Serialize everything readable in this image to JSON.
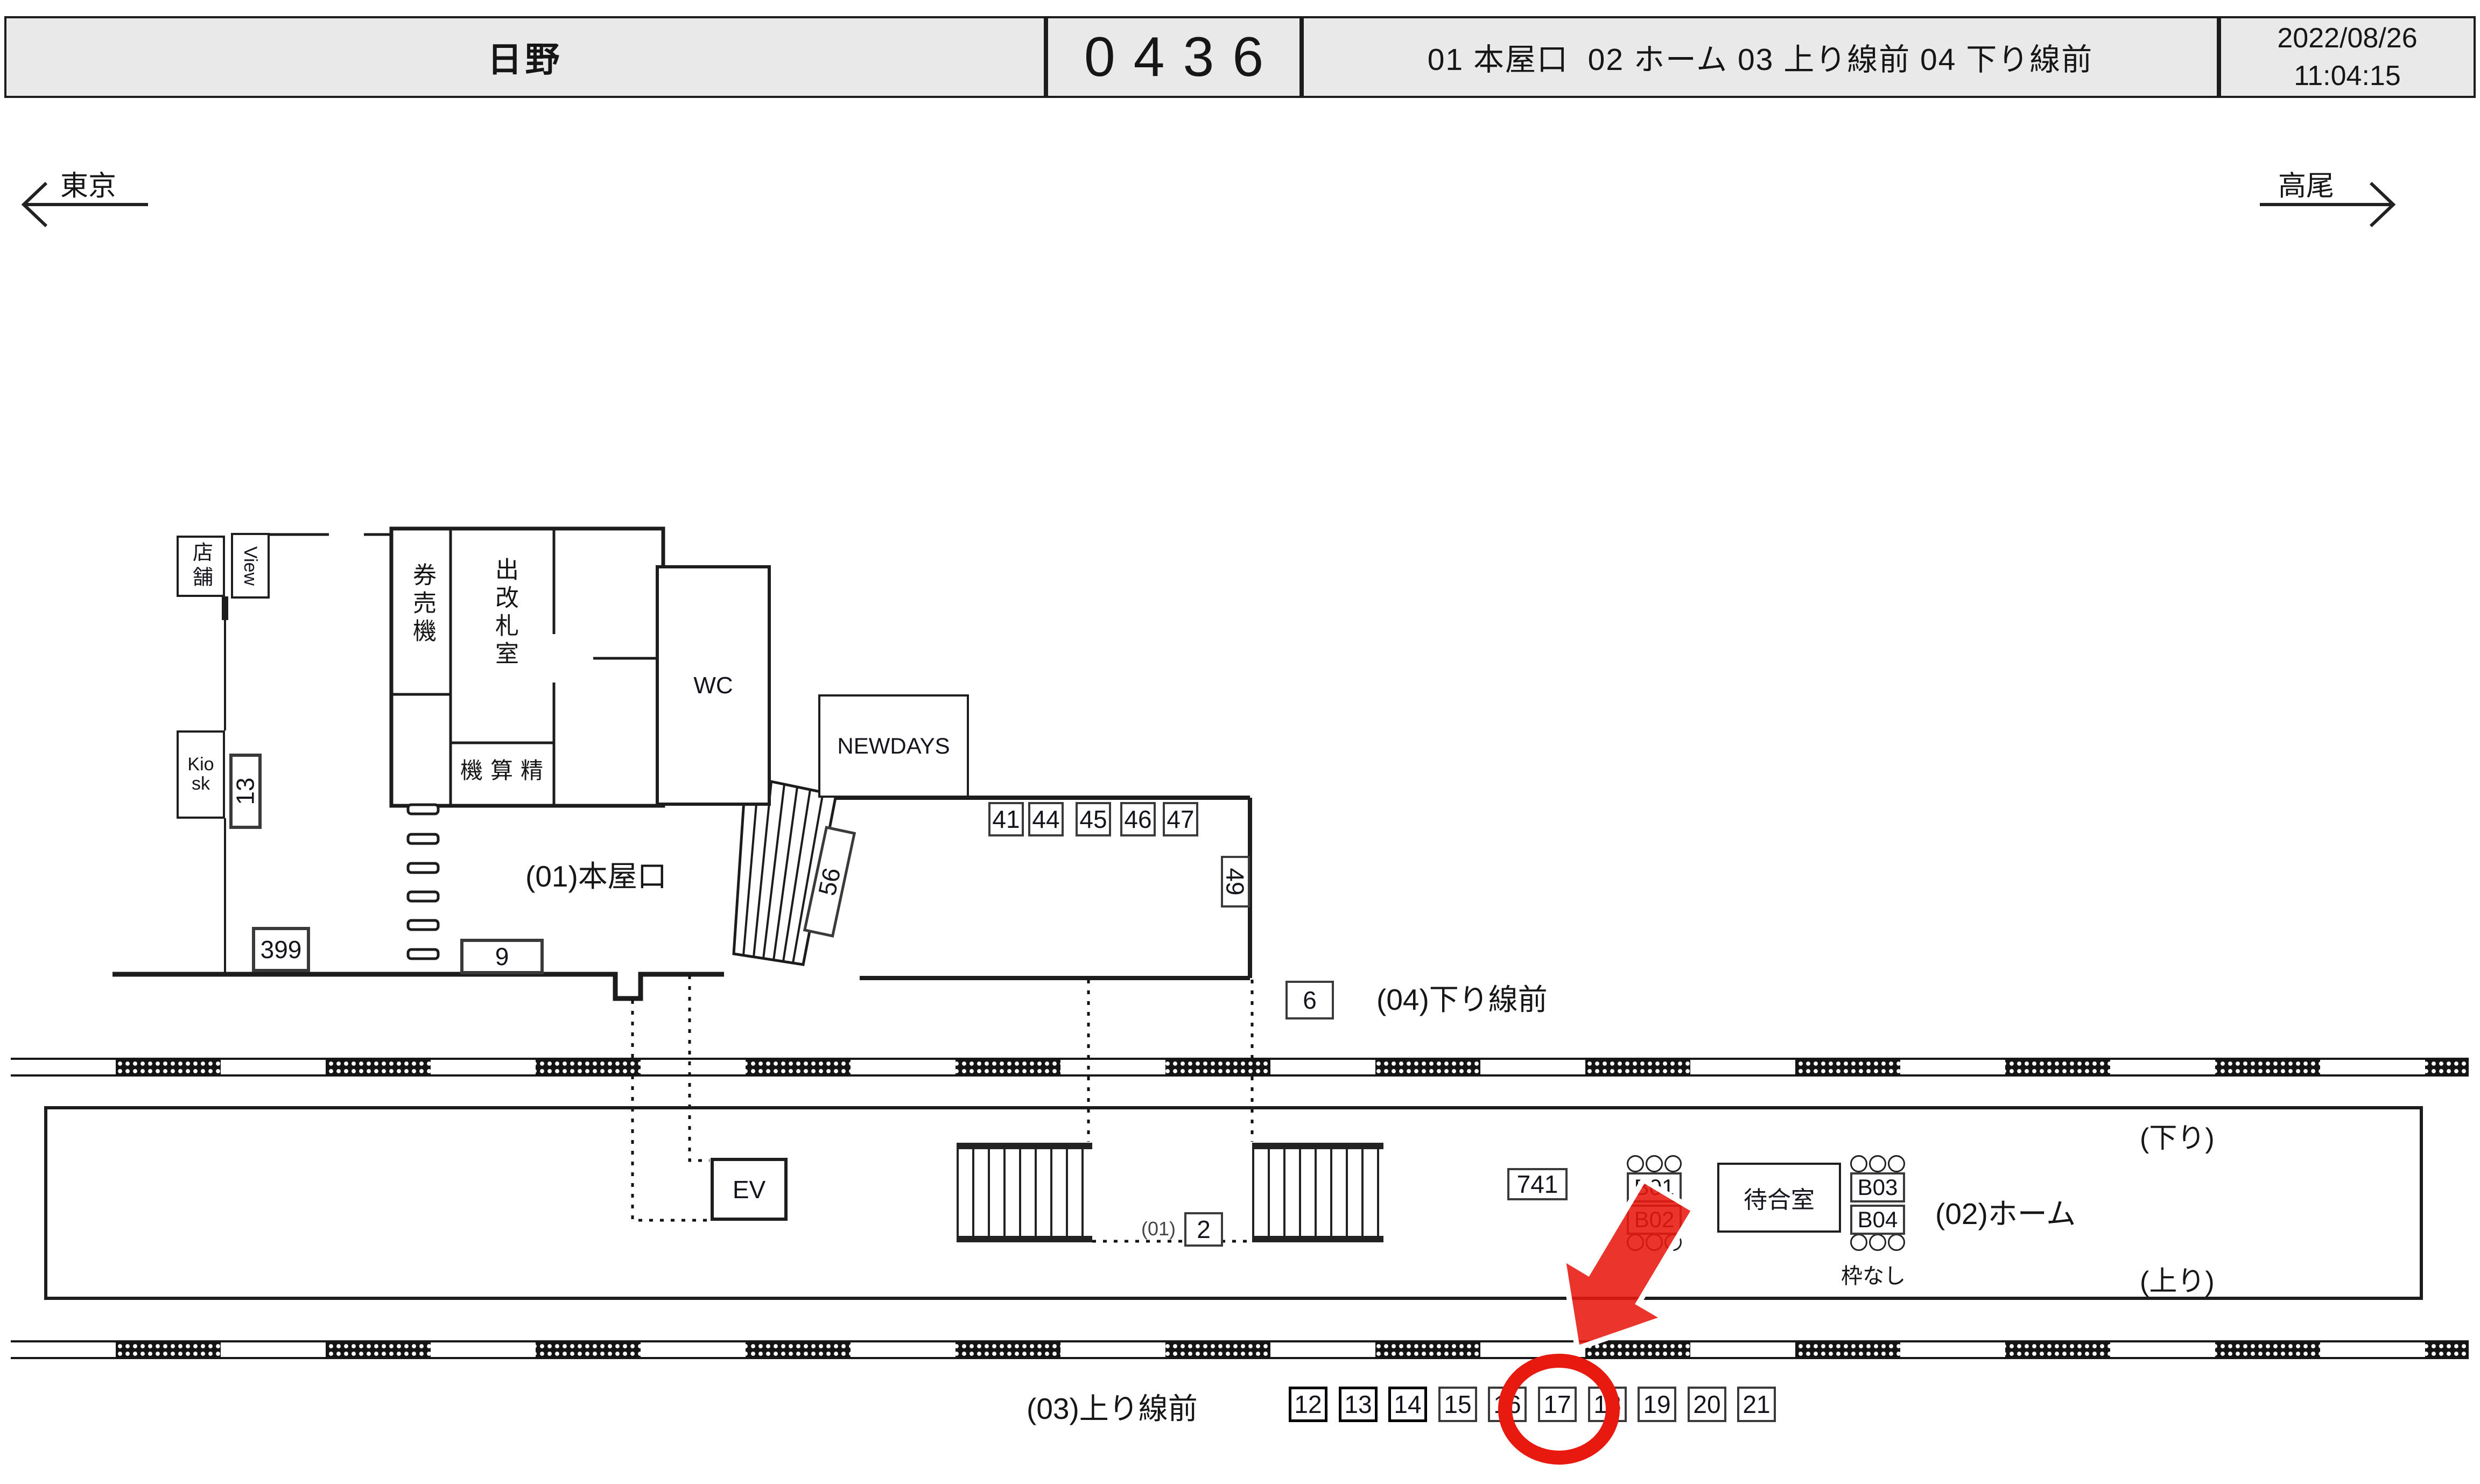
{
  "header": {
    "station": "日野",
    "code": "0436",
    "zones": "01 本屋口  02 ホーム 03 上り線前 04 下り線前",
    "date": "2022/08/26",
    "time": "11:04:15"
  },
  "directions": {
    "left": "東京",
    "right": "高尾"
  },
  "rooms": {
    "tenpo": "店舗",
    "view": "View",
    "kiosk": "Kiosk",
    "kenbaiki": "券売機",
    "kaisatsu": "出改札室",
    "seisanki": "機算精",
    "wc": "WC",
    "newdays": "NEWDAYS",
    "ev": "EV",
    "waiting": "待合室"
  },
  "area_labels": {
    "a01": "(01)本屋口",
    "a02": "(02)ホーム",
    "a03": "(03)上り線前",
    "a04": "(04)下り線前",
    "down": "(下り)",
    "up": "(上り)",
    "wakunashi": "枠なし",
    "pos_prefix": "(01)"
  },
  "plates": {
    "p399": "399",
    "p13": "13",
    "p9": "9",
    "p56": "56",
    "p41": "41",
    "p44": "44",
    "p45": "45",
    "p46": "46",
    "p47": "47",
    "p49": "49",
    "p6": "6",
    "p2": "2",
    "p741": "741",
    "b01": "B01",
    "b02": "B02",
    "b03": "B03",
    "b04": "B04",
    "row": [
      "12",
      "13",
      "14",
      "15",
      "16",
      "17",
      "18",
      "19",
      "20",
      "21"
    ]
  },
  "highlight": {
    "circled_plate": "17",
    "color": "#e8190f"
  }
}
